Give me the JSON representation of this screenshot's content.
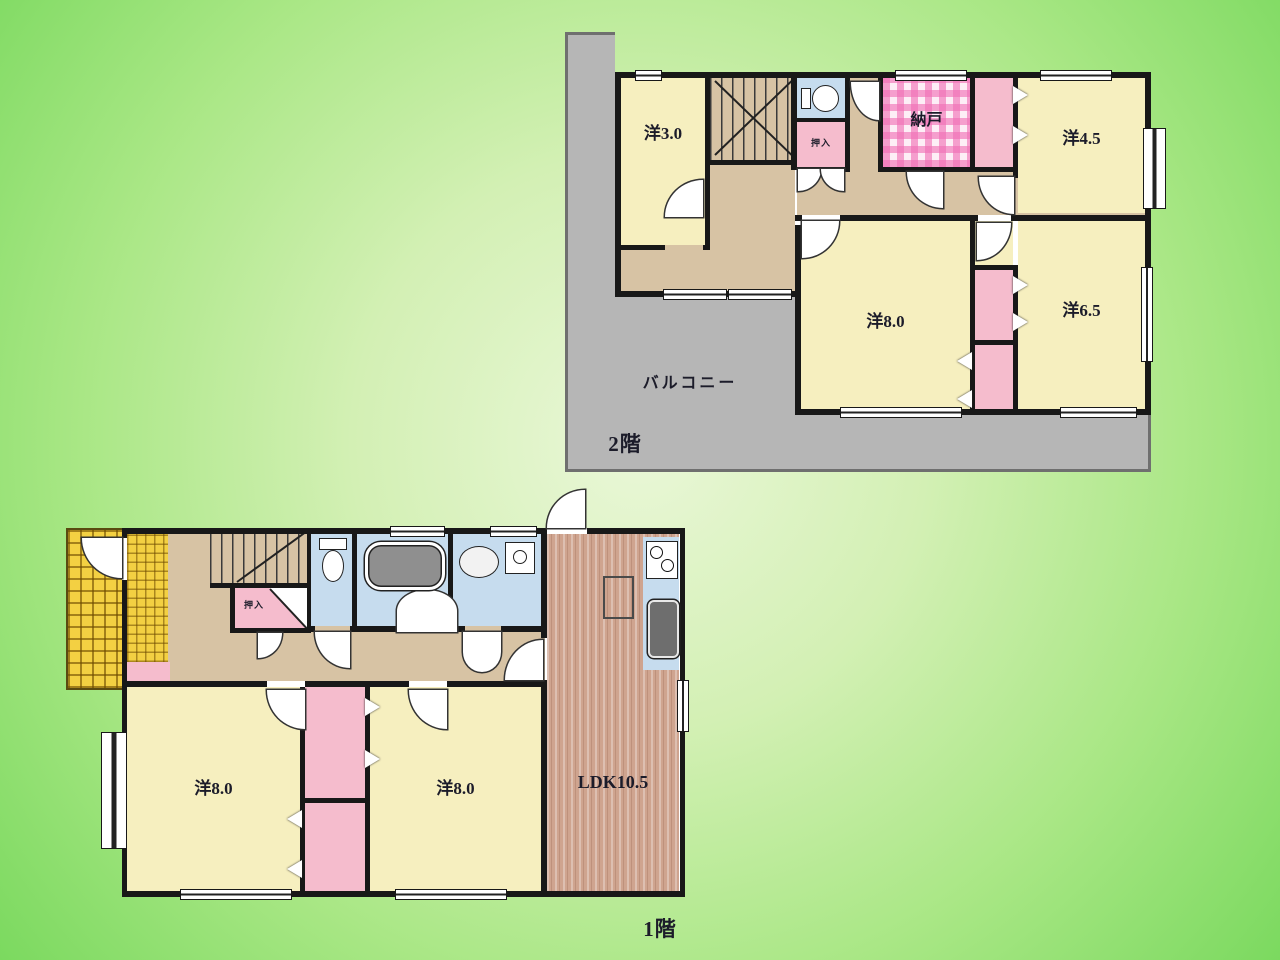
{
  "floor2": {
    "floor_label": "2階",
    "balcony_label": "バルコニー",
    "rooms": {
      "yo3": "洋3.0",
      "yo45": "洋4.5",
      "yo8": "洋8.0",
      "yo65": "洋6.5",
      "nando": "納戸",
      "oshiire": "押入"
    }
  },
  "floor1": {
    "floor_label": "1階",
    "rooms": {
      "left": "洋8.0",
      "right": "洋8.0",
      "ldk": "LDK10.5",
      "oshiire": "押入"
    }
  },
  "palette": {
    "background_center": "#eaf7d8",
    "background_edge": "#7bd95f",
    "room_yellow": "#f6efbf",
    "hall_tan": "#d7c3a4",
    "closet_pink": "#f5bccd",
    "storage_check_pink": "#f06eb4",
    "water_blue": "#c6dcee",
    "balcony_gray": "#b6b6b6",
    "wood_brown": "#cfa48f",
    "entrance_tile_yellow": "#f3d042",
    "wall_black": "#181818"
  },
  "icons": {
    "toilet": "toilet-icon",
    "bathtub": "bathtub-icon",
    "sink": "sink-icon",
    "washer": "washing-machine-icon",
    "stove": "stove-icon",
    "kitchen_sink": "kitchen-sink-icon",
    "door": "door-swing-arc-icon",
    "closet_arrow": "sliding-door-arrow-icon"
  }
}
